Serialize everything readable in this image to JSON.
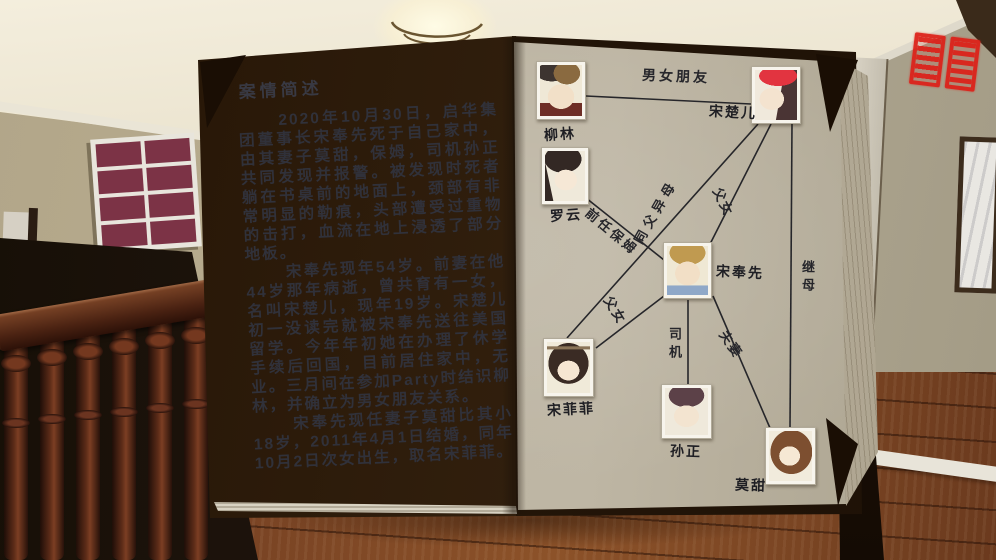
{
  "colors": {
    "seal_red": "#dd2018",
    "page_text": "#30313a",
    "diagram_line": "#26262a",
    "window_pane": "#7c3346"
  },
  "icons": {
    "seal": "red-seal-stamp",
    "lamp": "ceiling-lamp"
  },
  "book": {
    "left_page": {
      "title": "案情简述",
      "paragraphs": [
        "2020年10月30日，启华集团董事长宋奉先死于自己家中，由其妻子莫甜，保姆，司机孙正共同发现并报警。被发现时死者躺在书桌前的地面上，颈部有非常明显的勒痕，头部遭受过重物的击打，血流在地上浸透了部分地板。",
        "宋奉先现年54岁。前妻在他44岁那年病逝，曾共育有一女，名叫宋楚儿，现年19岁。宋楚儿初一没读完就被宋奉先送往美国留学。今年年初她在办理了休学手续后回国，目前居住家中，无业。三月间在参加Party时结识柳林，并确立为男女朋友关系。",
        "宋奉先现任妻子莫甜比其小18岁，2011年4月1日结婚，同年10月2日次女出生，取名宋菲菲。"
      ]
    },
    "diagram": {
      "portraits": {
        "liulin": {
          "label": "柳林"
        },
        "songchuer": {
          "label": "宋楚儿"
        },
        "luoyun": {
          "label": "罗云"
        },
        "songfengxian": {
          "label": "宋奉先"
        },
        "songfeifei": {
          "label": "宋菲菲"
        },
        "sunzheng": {
          "label": "孙正"
        },
        "motian": {
          "label": "莫甜"
        }
      },
      "relations": [
        {
          "from": "柳林",
          "to": "宋楚儿",
          "label": "男女朋友"
        },
        {
          "from": "宋楚儿",
          "to": "宋奉先",
          "label": "父女"
        },
        {
          "from": "宋楚儿",
          "to": "莫甜",
          "label": "继母"
        },
        {
          "from": "罗云",
          "to": "宋奉先",
          "label": "前任保姆"
        },
        {
          "from": "宋菲菲",
          "to": "宋楚儿",
          "label": "同父异母"
        },
        {
          "from": "宋菲菲",
          "to": "宋奉先",
          "label": "父女"
        },
        {
          "from": "宋奉先",
          "to": "孙正",
          "label": "司机"
        },
        {
          "from": "宋奉先",
          "to": "莫甜",
          "label": "夫妻"
        }
      ]
    }
  }
}
